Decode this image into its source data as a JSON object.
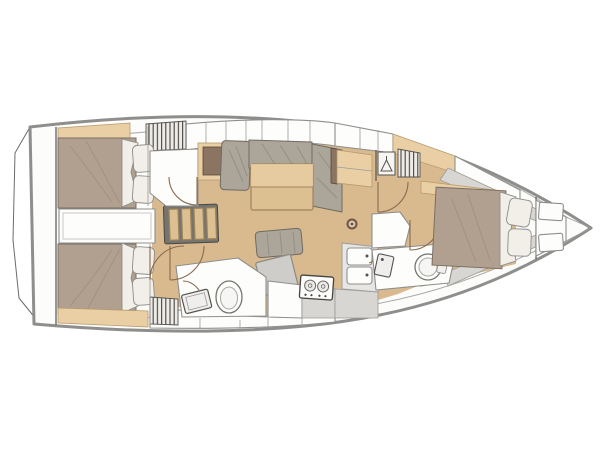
{
  "diagram": {
    "kind": "sailing-yacht-interior-floor-plan",
    "view": "top-down",
    "bow_direction": "right",
    "stern_direction": "left"
  },
  "colors": {
    "hull_outline": "#8e8e8c",
    "deck_white": "#fcfcfb",
    "counter_gray": "#d7d6d3",
    "floor_wood": "#d9ba8e",
    "cabinet_wood": "#eacfa4",
    "table_wood": "#ddc092",
    "dark_wood": "#8b7462",
    "upholstery": "#aca59a",
    "bed_blanket": "#b1a08f",
    "linen": "#f2efe8",
    "fixture_white": "#fdfdfc",
    "line_dark": "#55534f",
    "door_arc": "#8a6a4f",
    "hatch_bg": "#eeebe6"
  },
  "rooms": [
    "swim-platform",
    "aft-cabin-port",
    "aft-cabin-starboard",
    "engine-compartment",
    "companionway-steps",
    "saloon",
    "aft-head",
    "galley",
    "forward-head",
    "forward-cabin",
    "bow-locker"
  ],
  "furniture": {
    "aft_cabin_port": [
      "double-bed",
      "two-pillows",
      "hanging-locker",
      "cabinet"
    ],
    "aft_cabin_starboard": [
      "double-bed",
      "two-pillows",
      "hanging-locker",
      "cabinet"
    ],
    "saloon": [
      "u-shaped-settee",
      "dining-table",
      "side-shelf",
      "mast-step",
      "bench-seat",
      "chart-table",
      "dark-cabinet"
    ],
    "aft_head": [
      "toilet",
      "washbasin",
      "door-swing"
    ],
    "galley": [
      "two-burner-stove",
      "double-sink",
      "counters"
    ],
    "forward_head": [
      "toilet",
      "washbasin",
      "shower-seat",
      "hanging-locker",
      "hanger-symbol-locker"
    ],
    "forward_cabin": [
      "double-bed",
      "two-pillows",
      "shelf"
    ],
    "bow_locker": [
      "hatch-box",
      "hatch-box"
    ]
  }
}
